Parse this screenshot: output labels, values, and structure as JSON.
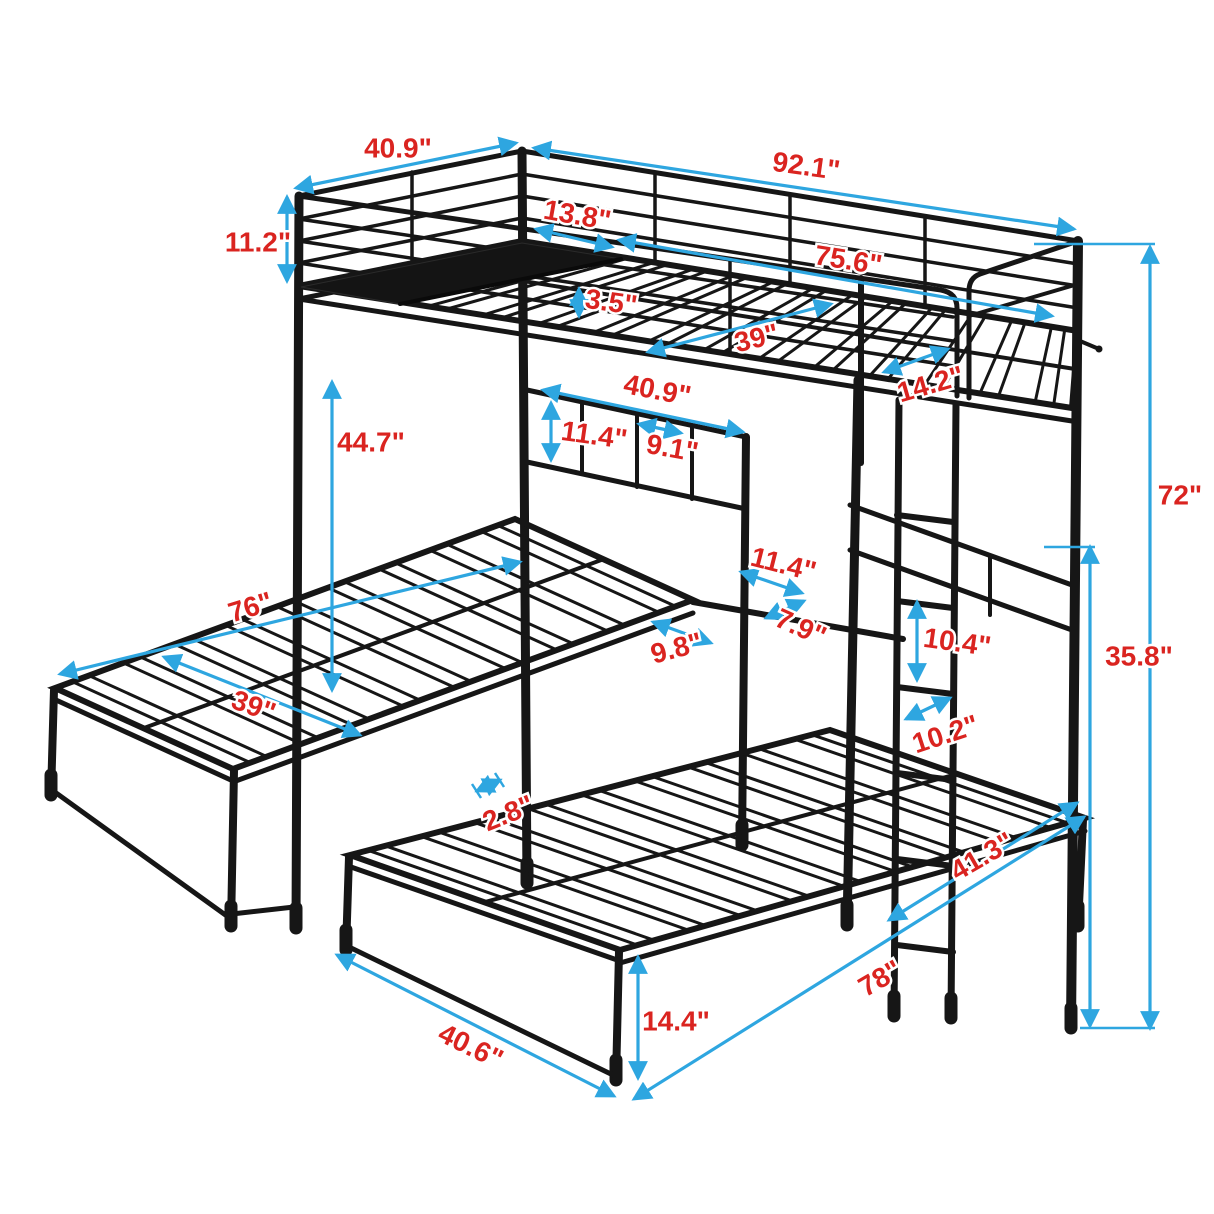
{
  "diagram": {
    "type": "product-dimension-diagram",
    "subject": "metal triple bunk bed (twin loft over two lower twin beds with ladder)",
    "unit": "inches",
    "background": "#ffffff"
  },
  "colors": {
    "arrow": "#2ea6e0",
    "dimension_text": "#da2420",
    "frame": "#161616",
    "shelf_fill": "#141414"
  },
  "dimensions": [
    {
      "id": "upper-head-end-width",
      "label": "40.9\"",
      "line": [
        296,
        188,
        516,
        143
      ],
      "label_pos": [
        398,
        150
      ],
      "rot": 0
    },
    {
      "id": "upper-overall-length",
      "label": "92.1\"",
      "line": [
        534,
        148,
        1074,
        229
      ],
      "label_pos": [
        806,
        168
      ],
      "rot": 8
    },
    {
      "id": "guardrail-height",
      "label": "11.2\"",
      "line": [
        287,
        197,
        287,
        281
      ],
      "label_pos": [
        258,
        244
      ],
      "rot": 0
    },
    {
      "id": "upper-shelf-depth",
      "label": "13.8\"",
      "line": [
        536,
        229,
        612,
        247
      ],
      "label_pos": [
        577,
        217
      ],
      "rot": 10
    },
    {
      "id": "upper-sleeping-length",
      "label": "75.6\"",
      "line": [
        619,
        240,
        1052,
        316
      ],
      "label_pos": [
        848,
        262
      ],
      "rot": 9
    },
    {
      "id": "side-rail-height",
      "label": "3.5\"",
      "line": [
        579,
        289,
        579,
        316
      ],
      "label_pos": [
        611,
        304
      ],
      "rot": 8
    },
    {
      "id": "upper-sleeping-width",
      "label": "39\"",
      "line": [
        648,
        352,
        831,
        304
      ],
      "label_pos": [
        757,
        340
      ],
      "rot": -14
    },
    {
      "id": "ladder-opening-width",
      "label": "14.2\"",
      "line": [
        884,
        372,
        948,
        349
      ],
      "label_pos": [
        931,
        386
      ],
      "rot": -16
    },
    {
      "id": "headboard-width",
      "label": "40.9\"",
      "line": [
        543,
        390,
        743,
        432
      ],
      "label_pos": [
        657,
        392
      ],
      "rot": 11
    },
    {
      "id": "headboard-bar-gap",
      "label": "11.4\"",
      "line": [
        551,
        403,
        551,
        460
      ],
      "label_pos": [
        594,
        437
      ],
      "rot": 8
    },
    {
      "id": "headboard-section-width",
      "label": "9.1\"",
      "line": [
        639,
        424,
        681,
        433
      ],
      "label_pos": [
        672,
        450
      ],
      "rot": 10
    },
    {
      "id": "under-bunk-clearance",
      "label": "44.7\"",
      "line": [
        332,
        382,
        332,
        690
      ],
      "label_pos": [
        371,
        444
      ],
      "rot": 0
    },
    {
      "id": "overall-height",
      "label": "72\"",
      "line": [
        1150,
        247,
        1150,
        1028
      ],
      "label_pos": [
        1180,
        497
      ],
      "rot": 0,
      "ticks": [
        [
          1034,
          244,
          1155,
          244
        ],
        [
          1080,
          1028,
          1155,
          1028
        ]
      ]
    },
    {
      "id": "tray-width",
      "label": "11.4\"",
      "line": [
        741,
        572,
        802,
        593
      ],
      "label_pos": [
        783,
        566
      ],
      "rot": 14
    },
    {
      "id": "tray-depth",
      "label": "7.9\"",
      "line": [
        766,
        618,
        804,
        601
      ],
      "label_pos": [
        800,
        629
      ],
      "rot": 24
    },
    {
      "id": "beds-gap",
      "label": "9.8\"",
      "line": [
        653,
        622,
        711,
        643
      ],
      "label_pos": [
        677,
        650
      ],
      "rot": -15
    },
    {
      "id": "ladder-rung-spacing",
      "label": "10.4\"",
      "line": [
        917,
        602,
        917,
        680
      ],
      "label_pos": [
        957,
        644
      ],
      "rot": 8
    },
    {
      "id": "ladder-width",
      "label": "10.2\"",
      "line": [
        906,
        719,
        950,
        698
      ],
      "label_pos": [
        946,
        736
      ],
      "rot": -18
    },
    {
      "id": "lower-structure-height",
      "label": "35.8\"",
      "line": [
        1090,
        547,
        1090,
        1026
      ],
      "label_pos": [
        1139,
        658
      ],
      "rot": 0,
      "ticks": [
        [
          1044,
          547,
          1095,
          547
        ]
      ]
    },
    {
      "id": "lower-bed-length",
      "label": "76\"",
      "line": [
        60,
        674,
        520,
        562
      ],
      "label_pos": [
        251,
        609
      ],
      "rot": -17
    },
    {
      "id": "lower-bed-width",
      "label": "39\"",
      "line": [
        164,
        657,
        360,
        735
      ],
      "label_pos": [
        253,
        708
      ],
      "rot": 20
    },
    {
      "id": "slat-pair-gap",
      "label": "2.8\"",
      "line": [
        477,
        791,
        500,
        780
      ],
      "label_pos": [
        509,
        815
      ],
      "rot": -22,
      "ticks": [
        [
          472,
          784,
          481,
          798
        ],
        [
          495,
          773,
          504,
          787
        ]
      ]
    },
    {
      "id": "front-bed-head-width",
      "label": "41.3\"",
      "line": [
        889,
        920,
        1077,
        803
      ],
      "label_pos": [
        983,
        858
      ],
      "rot": -30
    },
    {
      "id": "front-bed-length",
      "label": "78\"",
      "line": [
        634,
        1099,
        1084,
        817
      ],
      "label_pos": [
        881,
        980
      ],
      "rot": -30
    },
    {
      "id": "lower-leg-height",
      "label": "14.4\"",
      "line": [
        638,
        957,
        638,
        1078
      ],
      "label_pos": [
        676,
        1023
      ],
      "rot": 0
    },
    {
      "id": "front-bed-foot-width",
      "label": "40.6\"",
      "line": [
        337,
        955,
        614,
        1096
      ],
      "label_pos": [
        470,
        1048
      ],
      "rot": 26
    }
  ]
}
